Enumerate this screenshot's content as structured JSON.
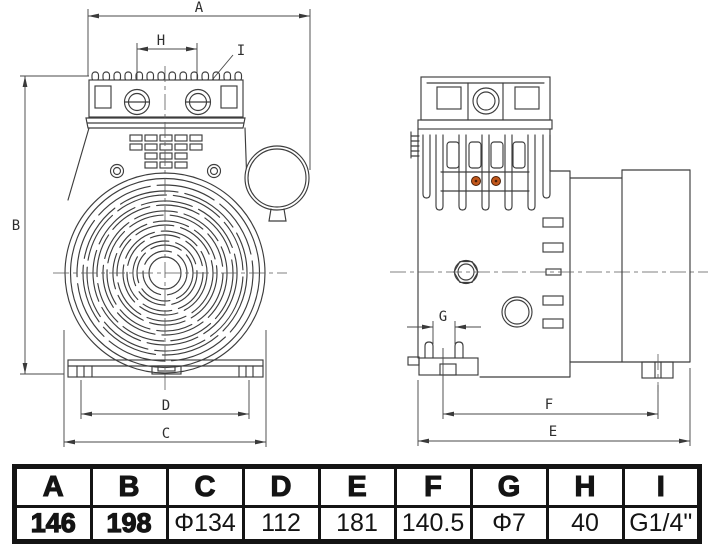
{
  "views": {
    "front": {
      "labels": {
        "A": "A",
        "B": "B",
        "C": "C",
        "D": "D",
        "H": "H",
        "I": "I"
      }
    },
    "side": {
      "labels": {
        "E": "E",
        "F": "F",
        "G": "G"
      }
    }
  },
  "dimension_table": {
    "headers": [
      "A",
      "B",
      "C",
      "D",
      "E",
      "F",
      "G",
      "H",
      "I"
    ],
    "values": [
      "146",
      "198",
      "Φ134",
      "112",
      "181",
      "140.5",
      "Φ7",
      "40",
      "G1/4\""
    ]
  },
  "colors": {
    "line": "#3d3d3d",
    "accent_dot": "#c2571b",
    "accent_dot_ring": "#4a2008",
    "table_text": "#141414"
  }
}
